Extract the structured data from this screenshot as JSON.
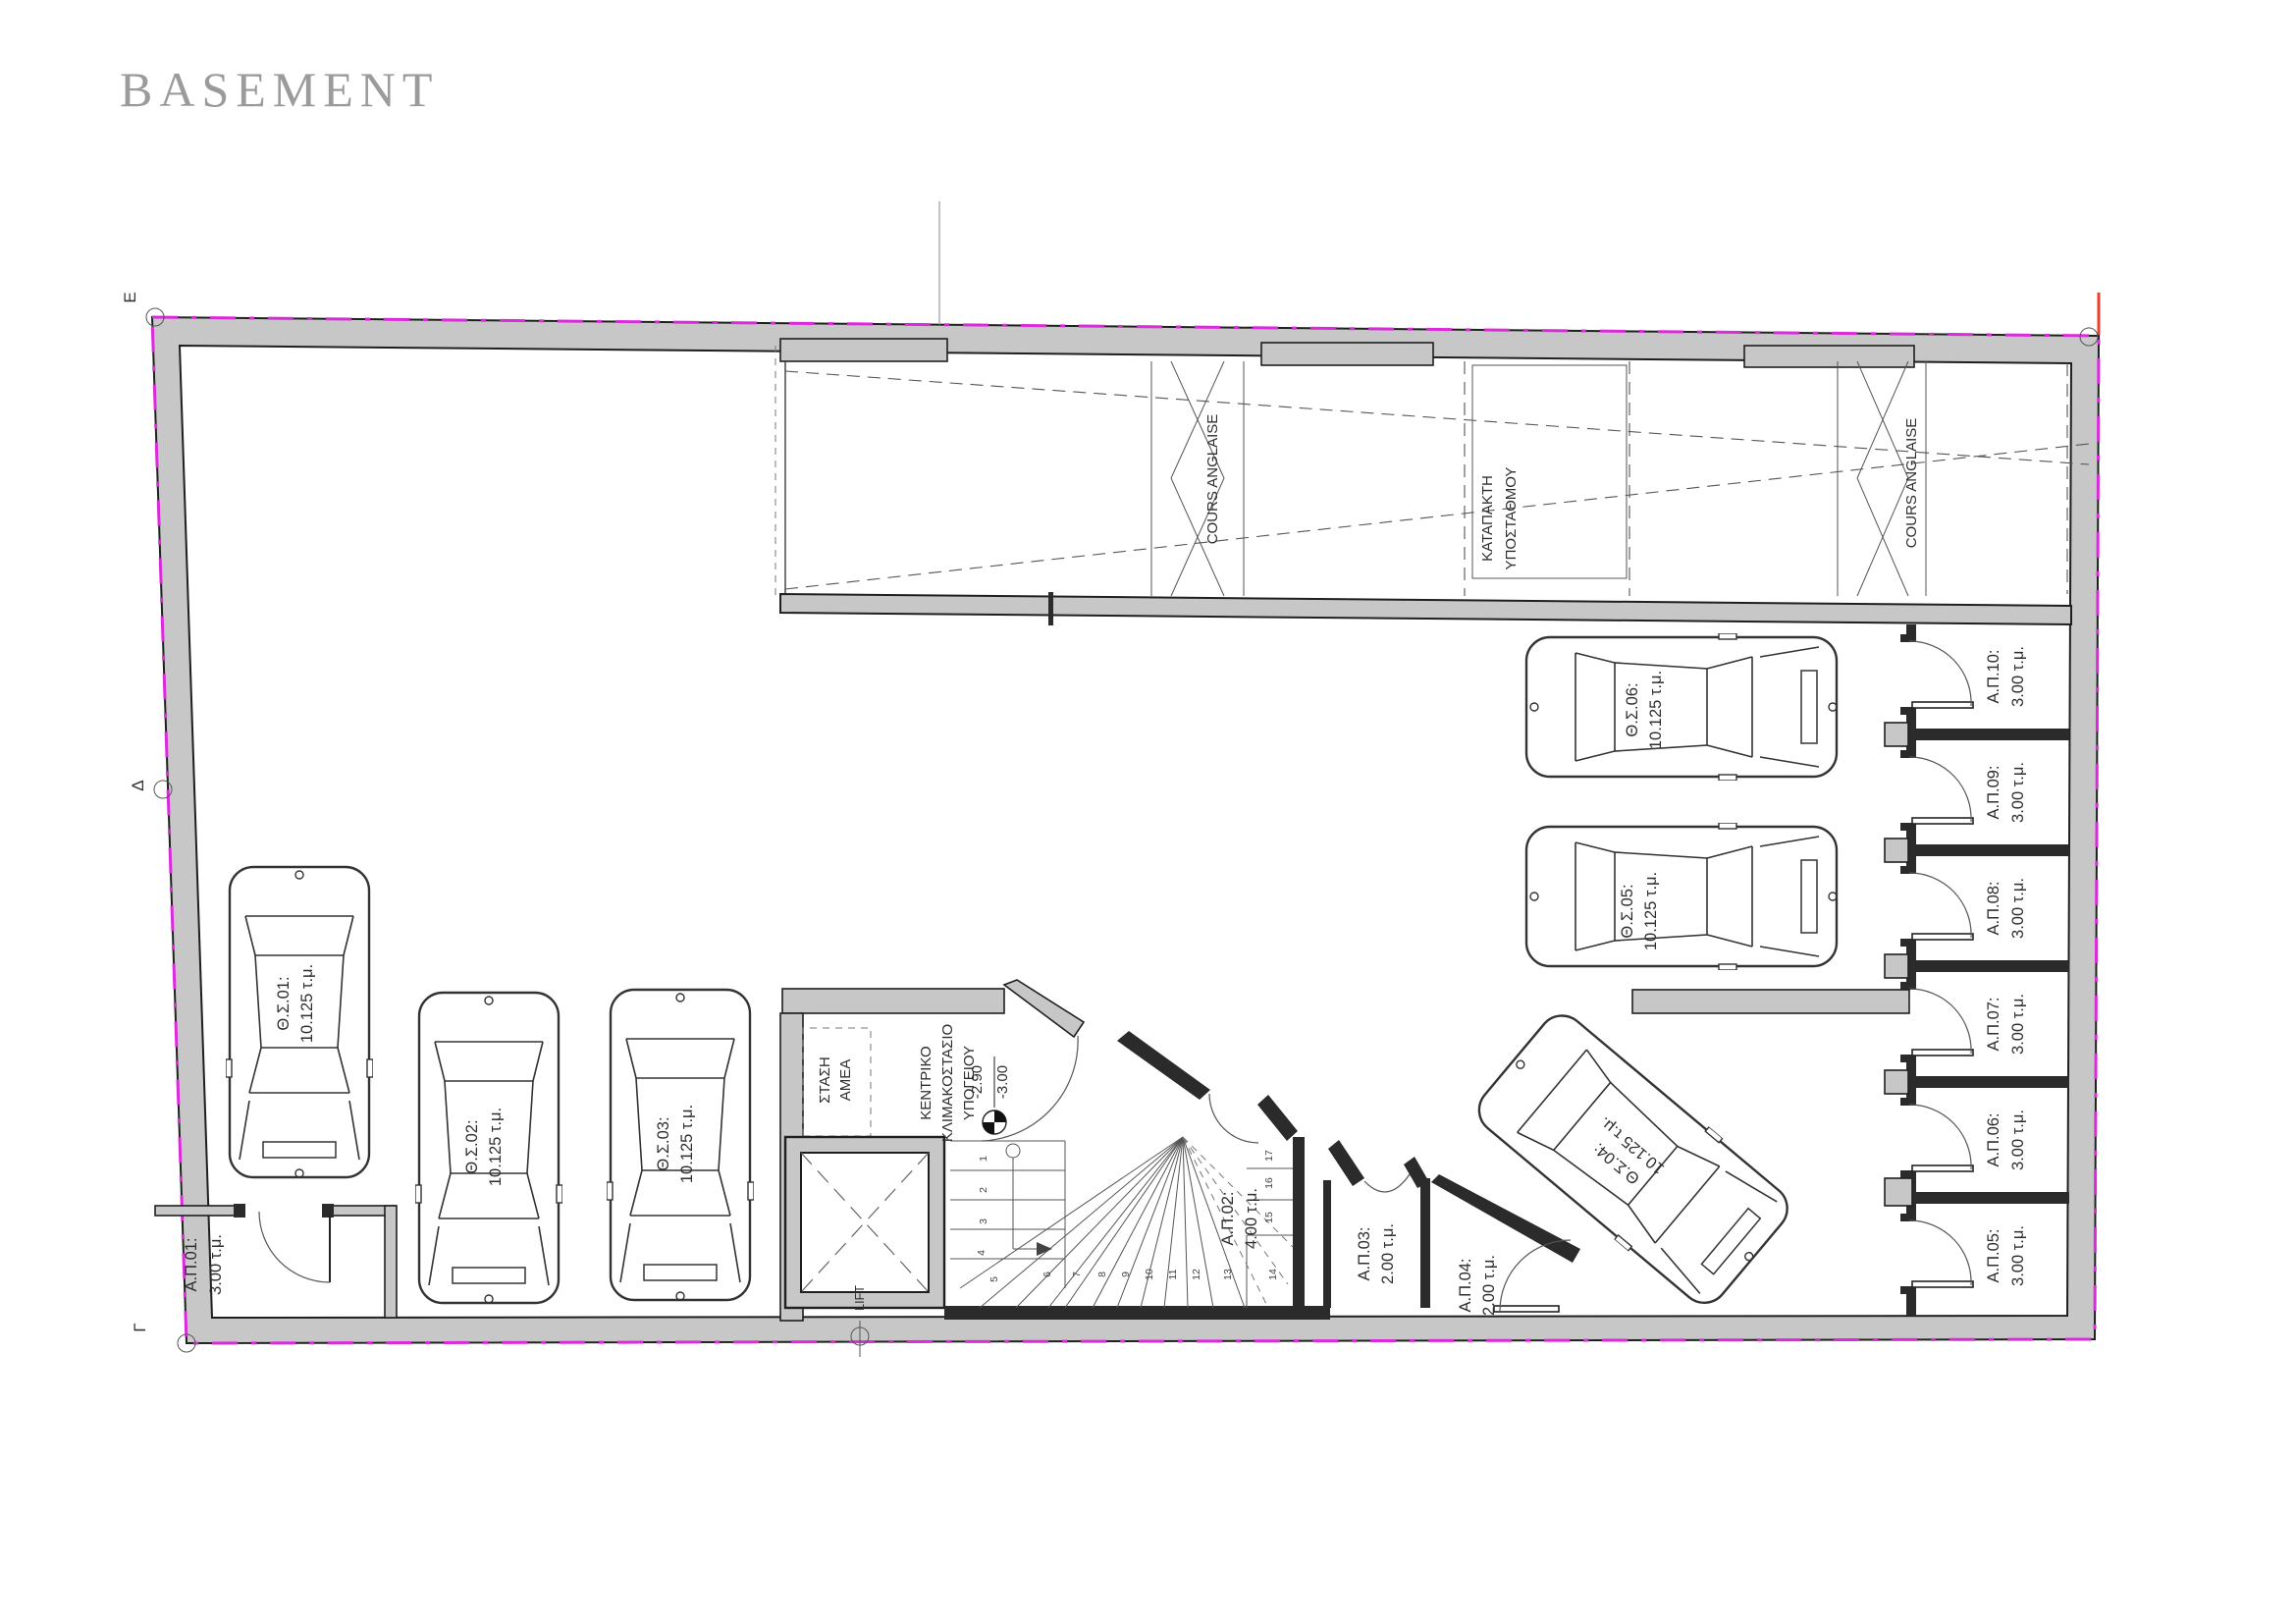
{
  "title": "BASEMENT",
  "colors": {
    "wall_fill": "#c7c7c7",
    "wall_stroke": "#1f1f1f",
    "boundary_magenta": "#d92bd9",
    "grid_red": "#e8402e",
    "text": "#2e2e2e"
  },
  "markers": {
    "top_left": "Ε",
    "mid_left": "Δ",
    "bottom_left": "Γ"
  },
  "strip": {
    "cours_anglaise_left": "COURS ANGLAISE",
    "cours_anglaise_right": "COURS ANGLAISE",
    "katapakti_line1": "ΚΑΤΑΠΑΚΤΗ",
    "katapakti_line2": "ΥΠΟΣΤΑΘΜΟΥ"
  },
  "core": {
    "stasi_line1": "ΣΤΑΣΗ",
    "stasi_line2": "ΑΜΕΑ",
    "title_line1": "ΚΕΝΤΡΙΚΟ",
    "title_line2": "ΚΛΙΜΑΚΟΣΤΑΣΙΟ",
    "title_line3": "ΥΠΟΓΕΙΟΥ",
    "level_upper": "-2.90",
    "level_lower": "-3.00",
    "lift": "LIFT"
  },
  "parking_spots": [
    {
      "id": "Θ.Σ.01:",
      "area": "10.125 τ.μ."
    },
    {
      "id": "Θ.Σ.02:",
      "area": "10.125 τ.μ."
    },
    {
      "id": "Θ.Σ.03:",
      "area": "10.125 τ.μ."
    },
    {
      "id": "Θ.Σ.04:",
      "area": "10.125 τ.μ."
    },
    {
      "id": "Θ.Σ.05:",
      "area": "10.125 τ.μ."
    },
    {
      "id": "Θ.Σ.06:",
      "area": "10.125 τ.μ."
    }
  ],
  "storage_rooms": [
    {
      "id": "Α.Π.01:",
      "area": "3.00 τ.μ."
    },
    {
      "id": "Α.Π.02:",
      "area": "4.00 τ.μ."
    },
    {
      "id": "Α.Π.03:",
      "area": "2.00 τ.μ."
    },
    {
      "id": "Α.Π.04:",
      "area": "2.00 τ.μ."
    },
    {
      "id": "Α.Π.05:",
      "area": "3.00 τ.μ."
    },
    {
      "id": "Α.Π.06:",
      "area": "3.00 τ.μ."
    },
    {
      "id": "Α.Π.07:",
      "area": "3.00 τ.μ."
    },
    {
      "id": "Α.Π.08:",
      "area": "3.00 τ.μ."
    },
    {
      "id": "Α.Π.09:",
      "area": "3.00 τ.μ."
    },
    {
      "id": "Α.Π.10:",
      "area": "3.00 τ.μ."
    }
  ],
  "stairs": {
    "steps": [
      "1",
      "2",
      "3",
      "4",
      "5",
      "6",
      "7",
      "8",
      "9",
      "10",
      "11",
      "12",
      "13",
      "14",
      "15",
      "16",
      "17"
    ]
  }
}
